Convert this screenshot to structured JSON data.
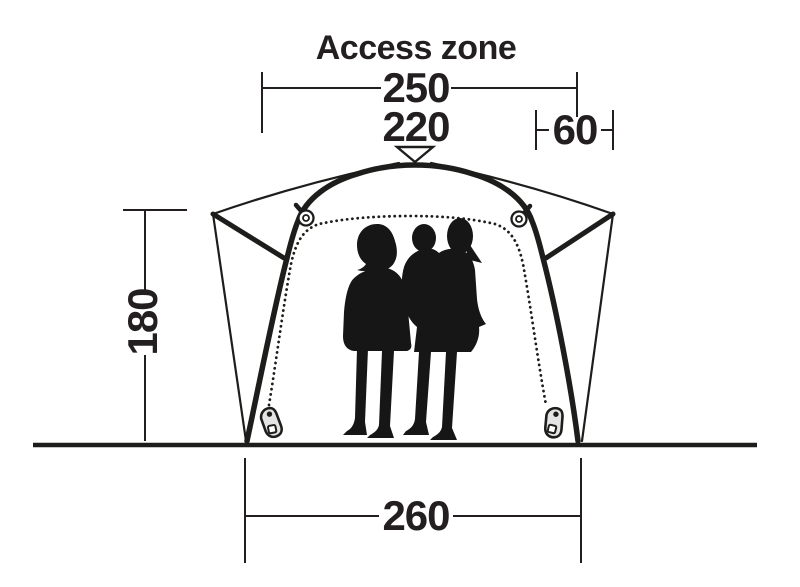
{
  "diagram": {
    "title": "Access zone",
    "dimensions": {
      "access_zone_width": "250",
      "inner_width": "220",
      "side_panel_width": "60",
      "height": "180",
      "base_width": "260"
    },
    "colors": {
      "background": "#ffffff",
      "line": "#1d1d1b",
      "text": "#231f20",
      "silhouette": "#161616",
      "zipper_pull_fill": "#e4e4e4"
    },
    "icons": [
      {
        "name": "peak-marker-icon",
        "shape": "open downward triangle at tent apex"
      },
      {
        "name": "ring-toggle-icon",
        "shape": "ring fastener hanging from canopy frame"
      },
      {
        "name": "zipper-pull-icon",
        "shape": "zipper slider at base of door zip"
      }
    ]
  }
}
